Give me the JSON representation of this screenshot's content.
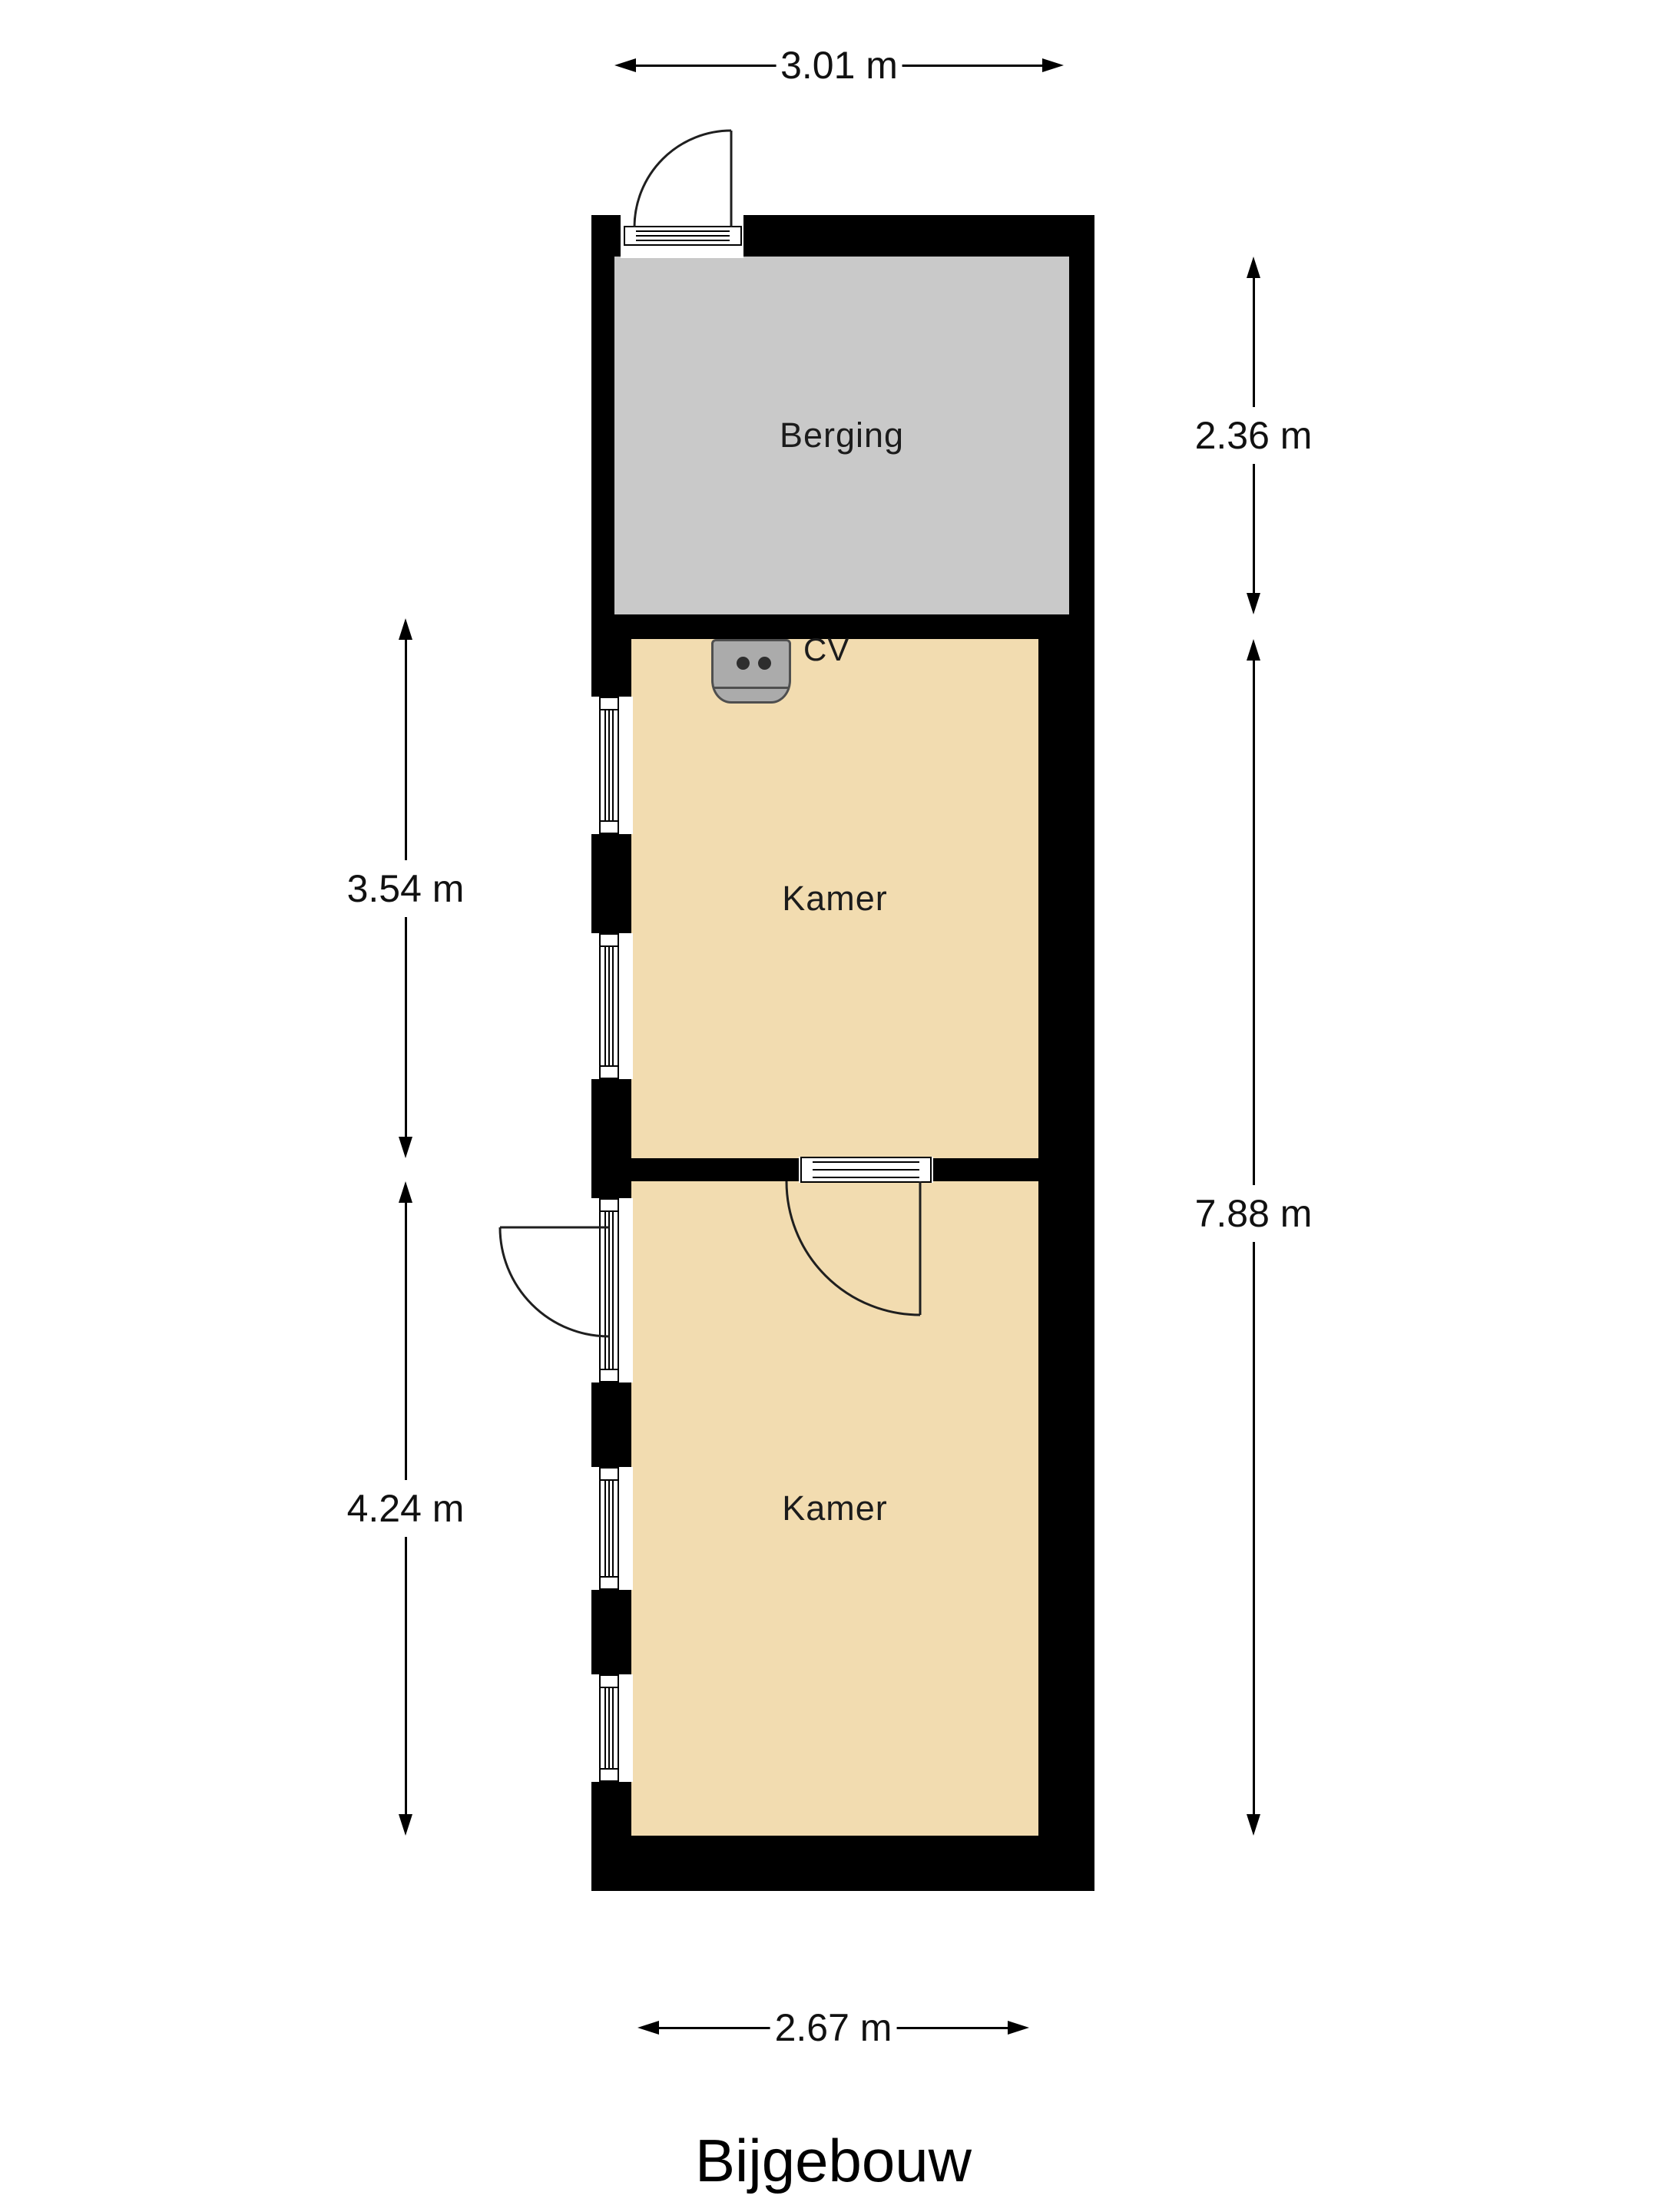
{
  "title": "Bijgebouw",
  "rooms": [
    {
      "name": "Berging"
    },
    {
      "name": "Kamer"
    },
    {
      "name": "Kamer"
    }
  ],
  "equipment": {
    "cv_label": "CV"
  },
  "dimensions": {
    "top_width": "3.01 m",
    "berging_height": "2.36 m",
    "kamer1_height": "3.54 m",
    "kamers_total_height": "7.88 m",
    "kamer2_height": "4.24 m",
    "bottom_width": "2.67 m"
  },
  "colors": {
    "wall": "#000000",
    "berging_fill": "#c9c9c9",
    "kamer_fill": "#f2dcb0",
    "cv_fill": "#ababab",
    "cv_border": "#4f4f4f",
    "line": "#111111"
  }
}
